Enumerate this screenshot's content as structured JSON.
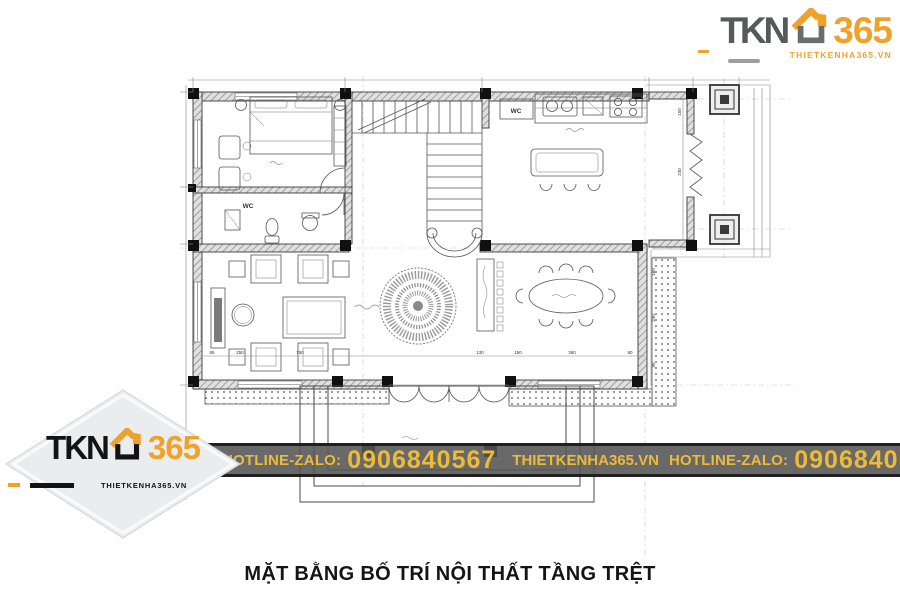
{
  "brand": {
    "name_part1": "TKN",
    "name_part2": "365",
    "website": "THIETKENHA365.VN"
  },
  "banner": {
    "hotline_label": "HOTLINE-ZALO:",
    "phone": "0906840567",
    "website": "THIETKENHA365.VN",
    "bg_color": "#545454",
    "text_color": "#EEBB37"
  },
  "title": "MẶT BẰNG BỐ TRÍ NỘI THẤT TẦNG TRỆT",
  "colors": {
    "brand_orange": "#EFA229",
    "logo_gray": "#58595B",
    "logo_black": "#131313",
    "diamond_bg": "#EBECEE",
    "plan_line": "#3A3A3A"
  },
  "plan": {
    "room_labels": {
      "bathroom": "WC",
      "closet": "WC"
    },
    "dims_bottom": [
      "85",
      "250",
      "750",
      "130",
      "150",
      "360",
      "90"
    ],
    "dims_right": [
      "160",
      "240",
      "90"
    ],
    "dims_annex": [
      "150",
      "240"
    ]
  }
}
